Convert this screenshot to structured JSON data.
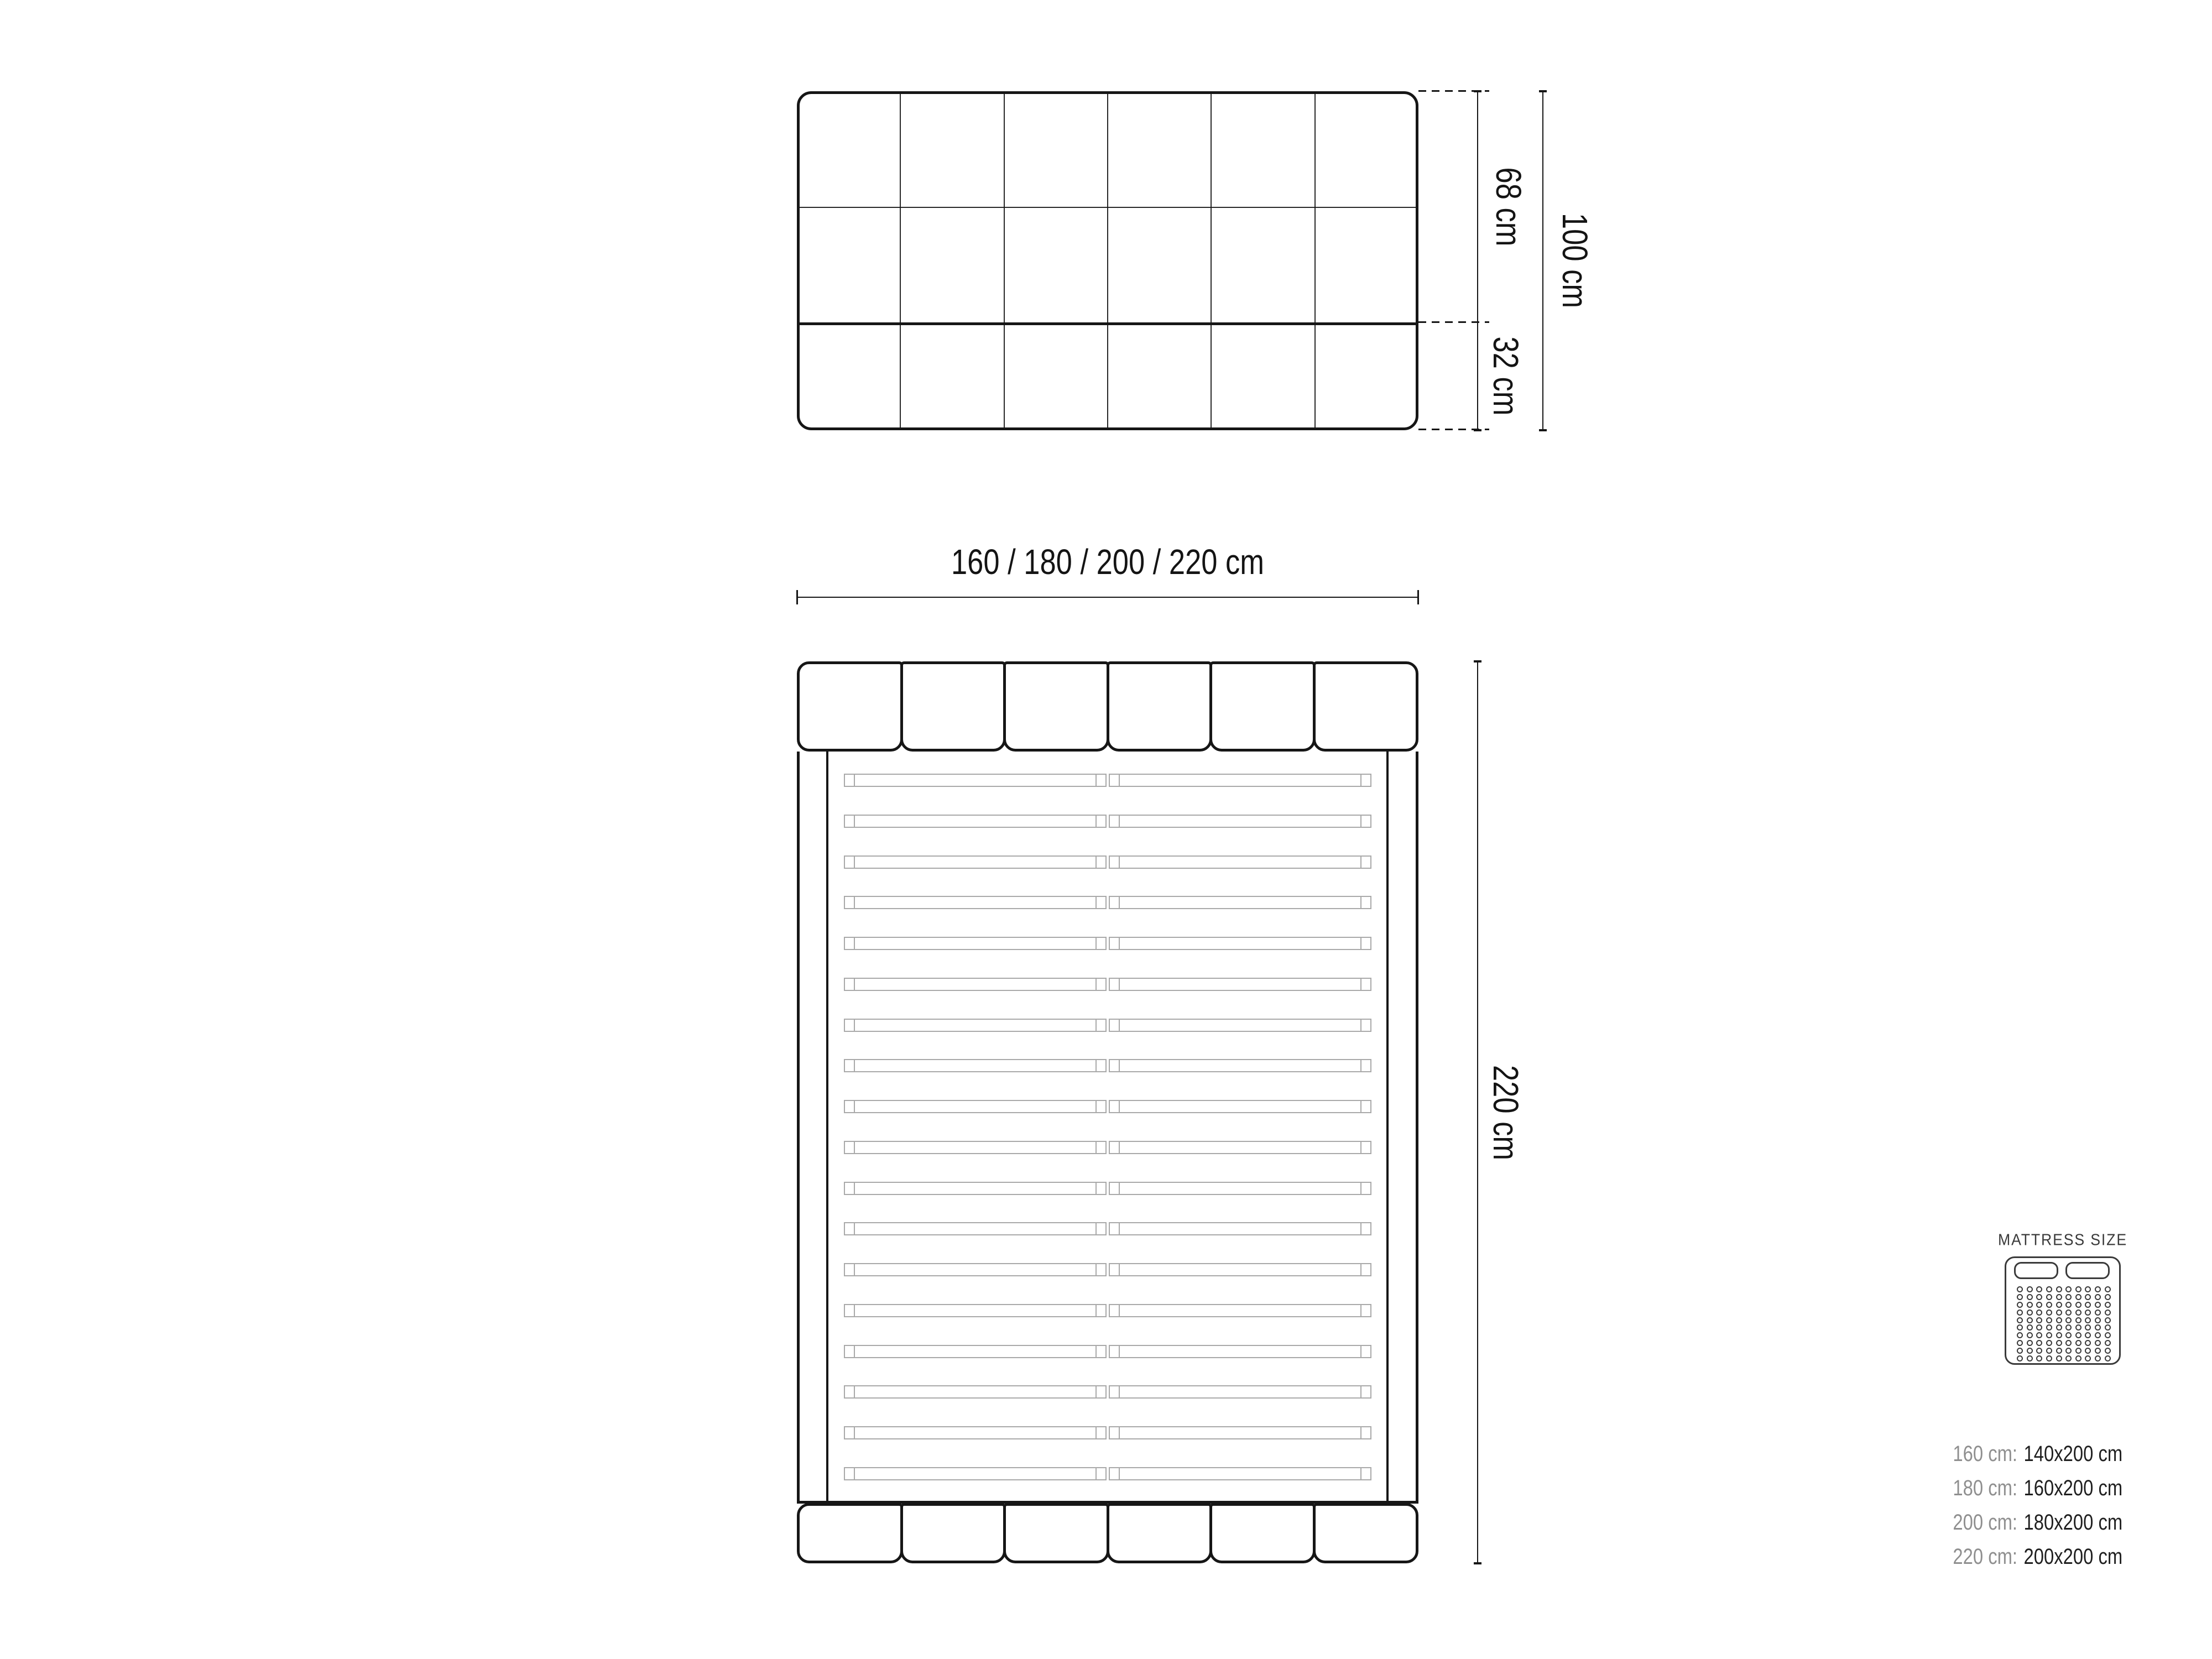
{
  "drawing": {
    "front_view": {
      "columns": 6,
      "rows": 3,
      "dim_upper_label": "68 cm",
      "dim_lower_label": "32 cm",
      "dim_total_label": "100 cm"
    },
    "width_dimension_label": "160 / 180 / 200 / 220 cm",
    "top_view": {
      "headboard_panels": 6,
      "footboard_panels": 6,
      "slat_rows": 18,
      "slat_columns": 2,
      "height_dimension_label": "220 cm"
    }
  },
  "legend": {
    "title": "MATTRESS SIZE",
    "rows": [
      {
        "frame_width": "160 cm:",
        "mattress_size": "140x200 cm"
      },
      {
        "frame_width": "180 cm:",
        "mattress_size": "160x200 cm"
      },
      {
        "frame_width": "200 cm:",
        "mattress_size": "180x200 cm"
      },
      {
        "frame_width": "220 cm:",
        "mattress_size": "200x200 cm"
      }
    ],
    "icon": {
      "pillow_count": 2,
      "dot_rows": 10,
      "dot_cols": 10
    }
  },
  "colors": {
    "line": "#161616",
    "slat_line": "#a9a9a9",
    "muted_text": "#8f8f8f",
    "dark_text": "#1f1f1f",
    "icon_stroke": "#3a3a3a",
    "background": "#ffffff"
  }
}
